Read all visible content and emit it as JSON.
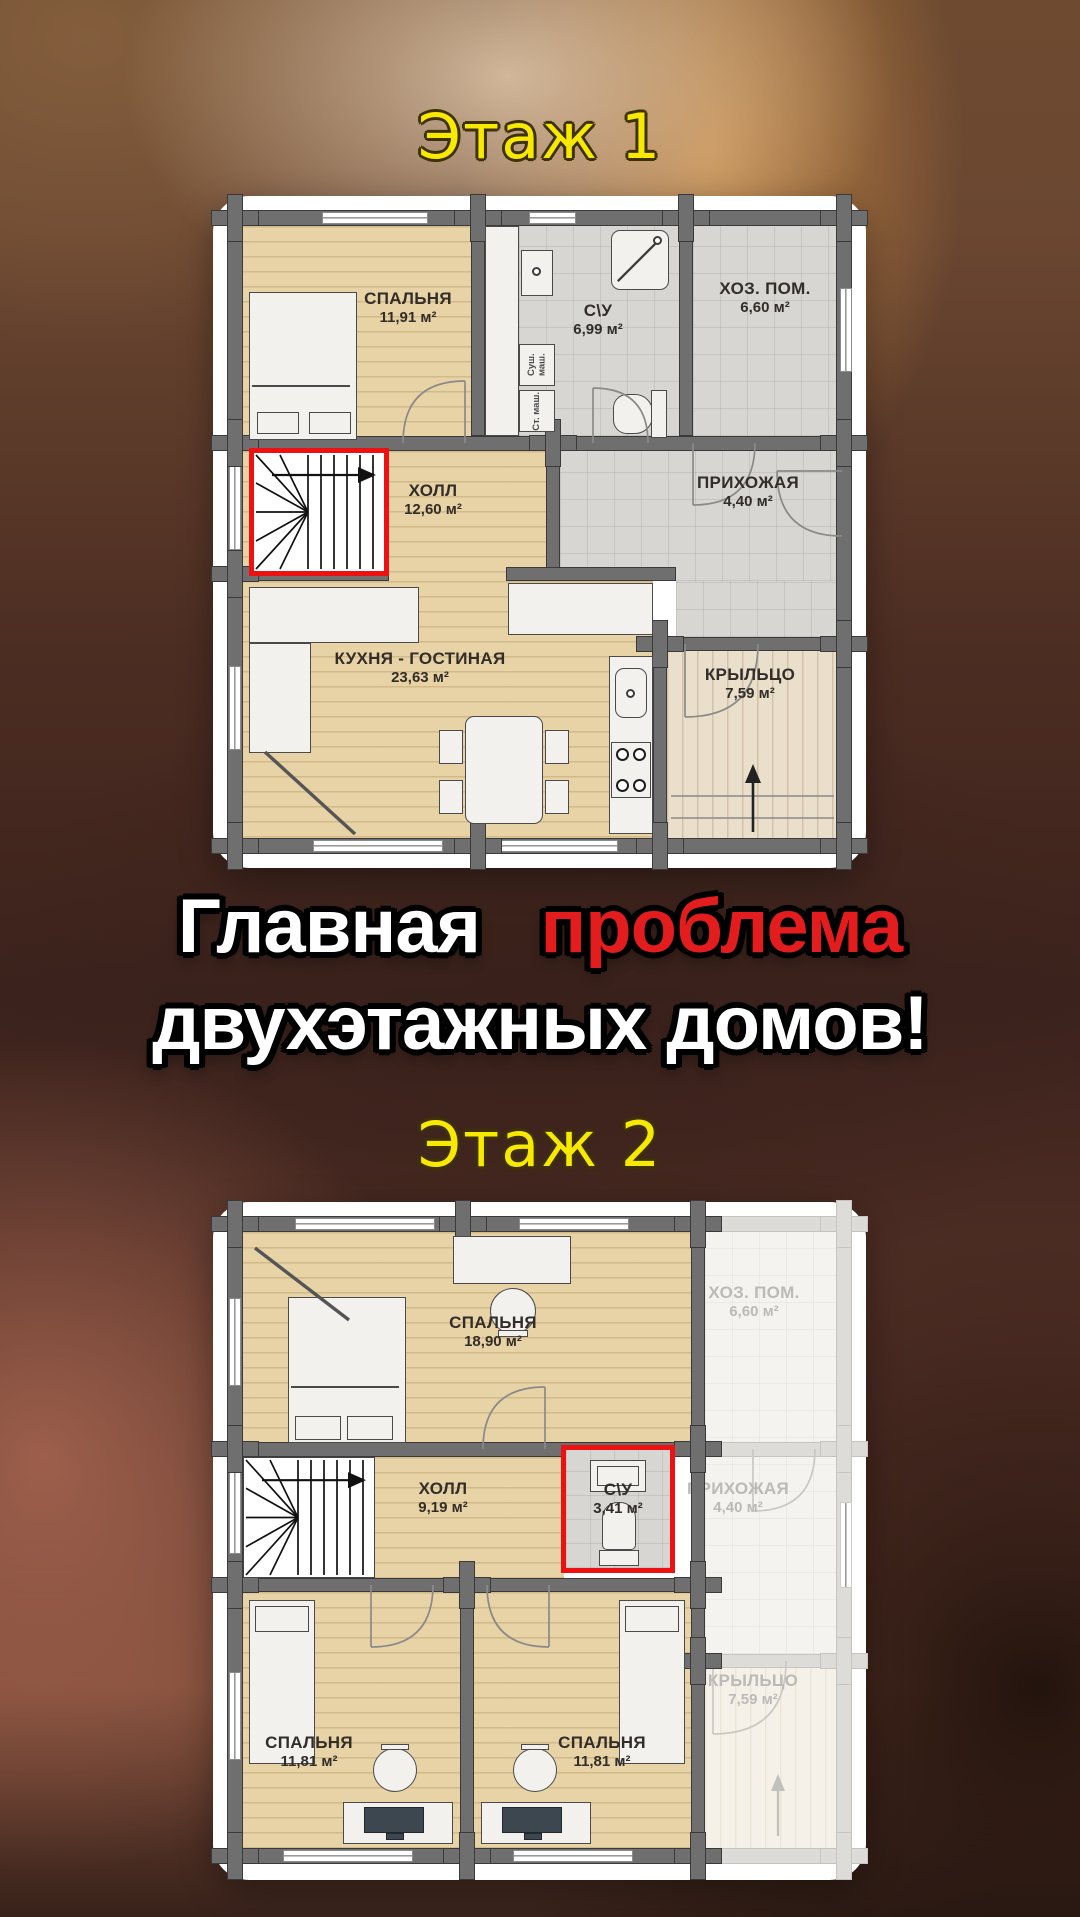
{
  "titles": {
    "floor1": "Этаж 1",
    "floor2": "Этаж 2"
  },
  "headline": {
    "word1": "Главная",
    "word2": "проблема",
    "line2": "двухэтажных домов!"
  },
  "floor1": {
    "rooms": {
      "bedroom": {
        "name": "СПАЛЬНЯ",
        "area": "11,91 м²"
      },
      "bathroom": {
        "name": "С\\У",
        "area": "6,99 м²"
      },
      "utility": {
        "name": "ХОЗ. ПОМ.",
        "area": "6,60 м²"
      },
      "hall": {
        "name": "ХОЛЛ",
        "area": "12,60 м²"
      },
      "entry": {
        "name": "ПРИХОЖАЯ",
        "area": "4,40 м²"
      },
      "kitchen": {
        "name": "КУХНЯ - ГОСТИНАЯ",
        "area": "23,63 м²"
      },
      "porch": {
        "name": "КРЫЛЬЦО",
        "area": "7,59 м²"
      }
    },
    "appliances": {
      "dryer": "Суш. маш.",
      "washer": "Ст. маш."
    }
  },
  "floor2": {
    "rooms": {
      "bedroom_big": {
        "name": "СПАЛЬНЯ",
        "area": "18,90 м²"
      },
      "hall": {
        "name": "ХОЛЛ",
        "area": "9,19 м²"
      },
      "bathroom": {
        "name": "С\\У",
        "area": "3,41 м²"
      },
      "bedroom_left": {
        "name": "СПАЛЬНЯ",
        "area": "11,81 м²"
      },
      "bedroom_right": {
        "name": "СПАЛЬНЯ",
        "area": "11,81 м²"
      }
    },
    "ghost": {
      "utility": {
        "name": "ХОЗ. ПОМ.",
        "area": "6,60 м²"
      },
      "entry": {
        "name": "ПРИХОЖАЯ",
        "area": "4,40 м²"
      },
      "porch": {
        "name": "КРЫЛЬЦО",
        "area": "7,59 м²"
      }
    }
  },
  "colors": {
    "title_yellow": "#f8e903",
    "headline_red": "#e31d1d",
    "highlight_red": "#ee1111"
  }
}
